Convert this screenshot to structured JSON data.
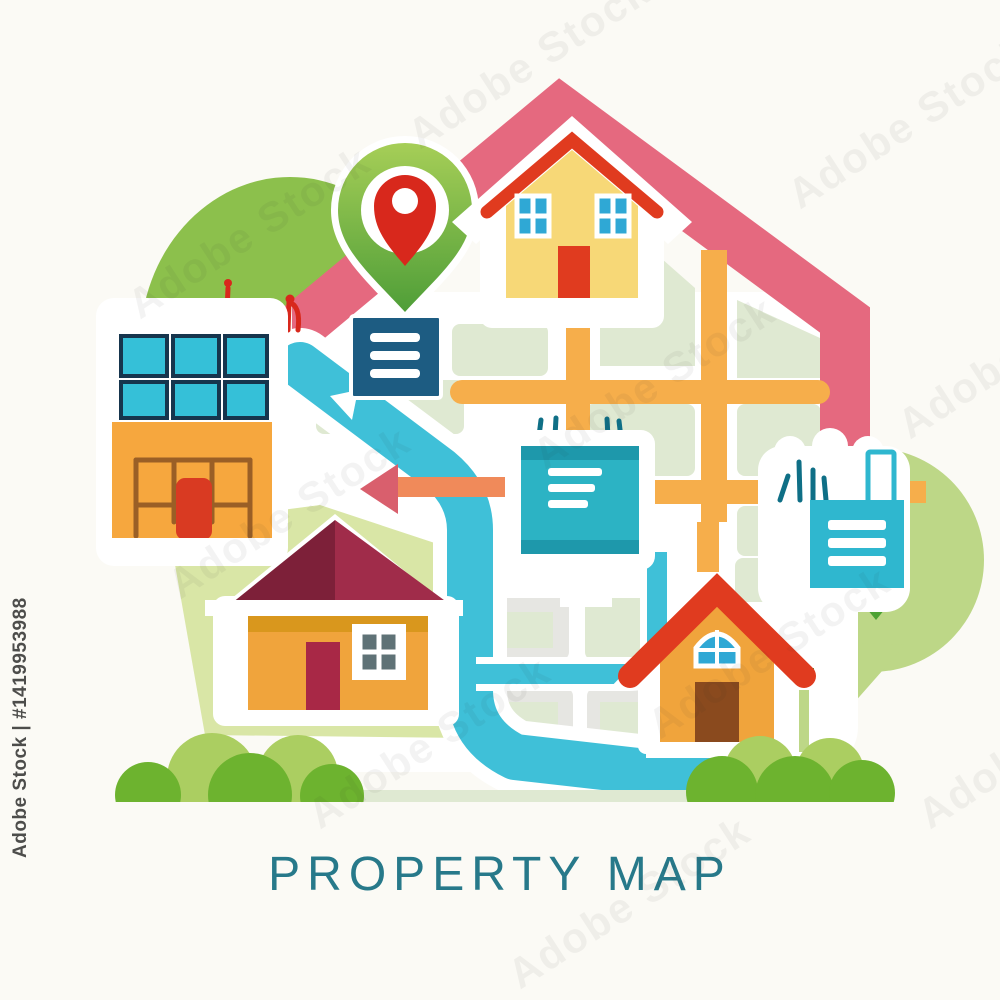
{
  "title": {
    "text": "PROPERTY MAP"
  },
  "watermark": {
    "ghost": "Adobe Stock",
    "credit": "Adobe Stock | #1419953988"
  },
  "palette": {
    "bg": "#fbfaf5",
    "title_teal": "#27798a",
    "watermark_gray": "#4d4d4b",
    "pink": "#e5697f",
    "pin_green_light": "#a6ce57",
    "pin_green_dark": "#4f9e38",
    "pin_red": "#d8281c",
    "dome_green": "#8cc04c",
    "blob_green_light": "#bdd787",
    "lawn": "#d9e6a6",
    "map_block": "#dfe9d2",
    "map_gray": "#e6e6e2",
    "road_orange": "#f6ae4b",
    "river": "#3fc0d8",
    "navy": "#1d5c82",
    "panel_teal": "#2cb3c4",
    "panel_teal_dark": "#1e98ab",
    "box_teal": "#2fb7cf",
    "doodle_teal": "#0f6f86",
    "doodle_red": "#d8281c",
    "arrow_salmon": "#f08a5a",
    "arrow_head": "#d95f6d",
    "house_yellow": "#f7d877",
    "roof_red": "#e03b1f",
    "window_blue": "#2fa8d5",
    "bldg_orange": "#f6a73e",
    "solar_cyan": "#35c0d8",
    "solar_outline": "#16354d",
    "grid_brown": "#9a5f26",
    "door_red": "#d93a22",
    "bl_body": "#f0a43c",
    "bl_band": "#d9971d",
    "bl_roof_dark": "#7d2039",
    "bl_roof_light": "#a02c4a",
    "bl_door": "#a82846",
    "bl_pane": "#5f7276",
    "br_door": "#8a4a1e",
    "bush_light": "#abce61",
    "bush_bright": "#6db32f",
    "tree_dark": "#4da234"
  },
  "scene": {
    "elements": [
      "map-pin-icon",
      "family-house-icon",
      "menu-sign-icon",
      "info-panel-icon",
      "solar-building-icon",
      "cottage-house-icon",
      "gabled-house-icon",
      "document-building-icon",
      "river",
      "orange-roads",
      "property-outline",
      "bushes",
      "trees",
      "direction-arrow-icon"
    ]
  }
}
